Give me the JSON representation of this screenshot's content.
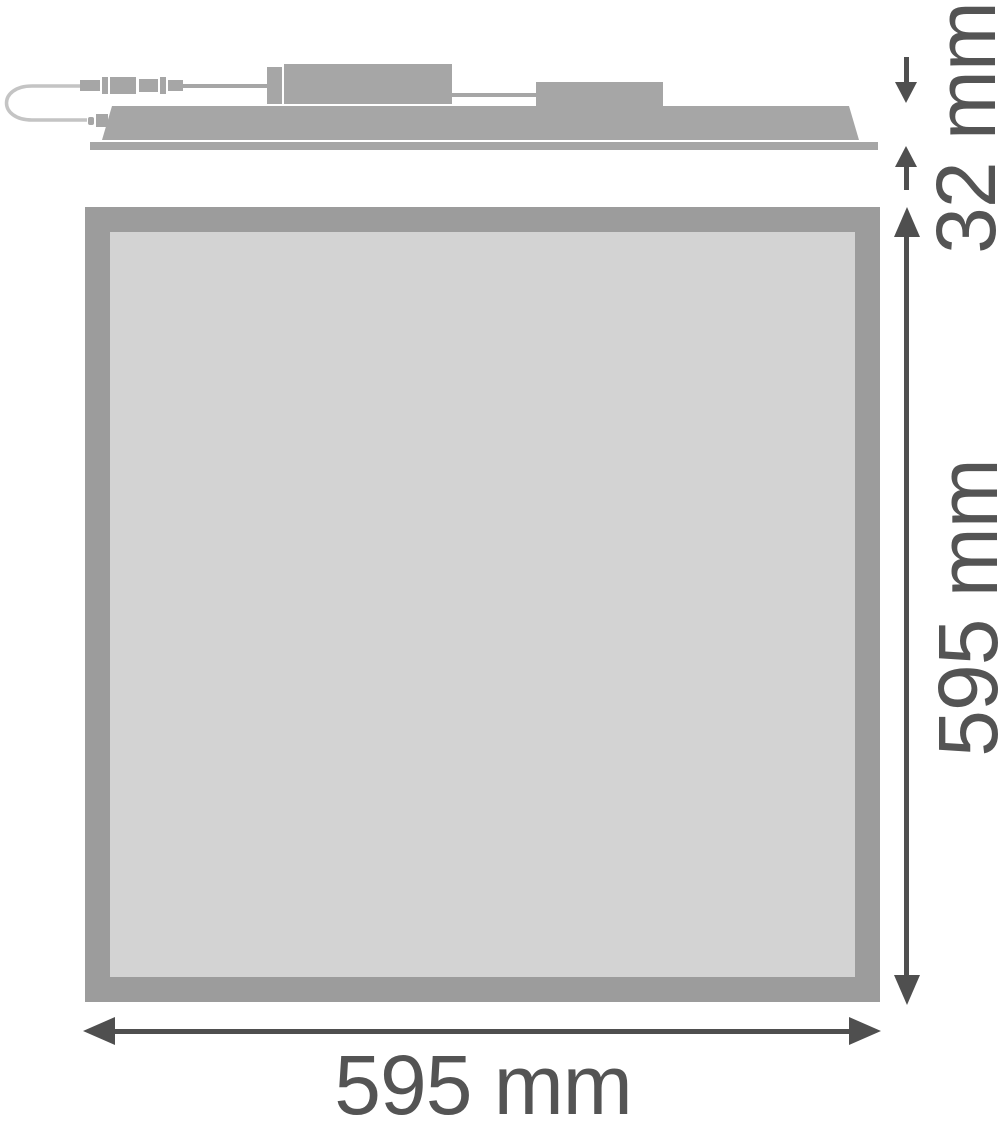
{
  "drawing": {
    "name": "LED panel luminaire dimension drawing",
    "views": {
      "side_profile": "panel side view with driver box, junction box and connector cable",
      "front": "panel front view"
    }
  },
  "dimensions": {
    "profile_height": "32 mm",
    "panel_height": "595 mm",
    "panel_width": "595 mm"
  },
  "colors": {
    "background": "#ffffff",
    "shape_gray": "#a6a6a6",
    "wire_gray": "#c4c4c4",
    "frame_gray": "#9c9c9c",
    "face_gray": "#d3d3d3",
    "dim_gray": "#4f4f4f",
    "text_gray": "#545454"
  }
}
